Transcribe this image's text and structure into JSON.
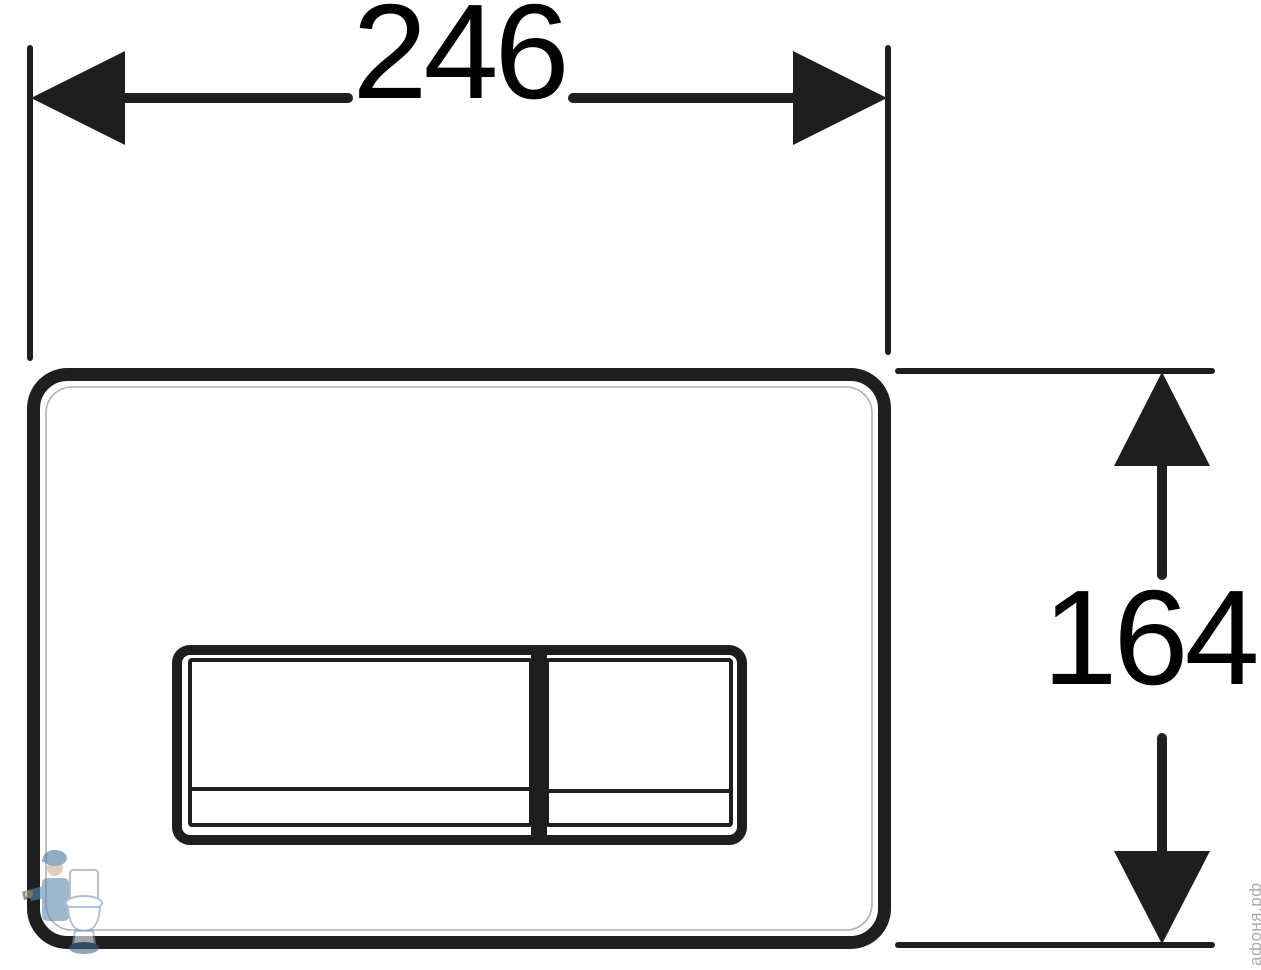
{
  "drawing": {
    "title": "flush-plate-dimension-drawing",
    "width_dim": "246",
    "height_dim": "164"
  },
  "watermark": {
    "text": "афоня.рф",
    "logo": "plumber-with-toilet-logo"
  },
  "icons": {
    "arrows": [
      "arrow-left-icon",
      "arrow-right-icon",
      "arrow-up-icon",
      "arrow-down-icon"
    ]
  },
  "colors": {
    "line": "#1e1e1e",
    "inner_edge": "#b0b0b0",
    "watermark_text": "#a3a3a3",
    "logo_blue": "#5d8ab0",
    "logo_blue_dark": "#41688e",
    "logo_outline_blue": "#7d9cb8"
  }
}
